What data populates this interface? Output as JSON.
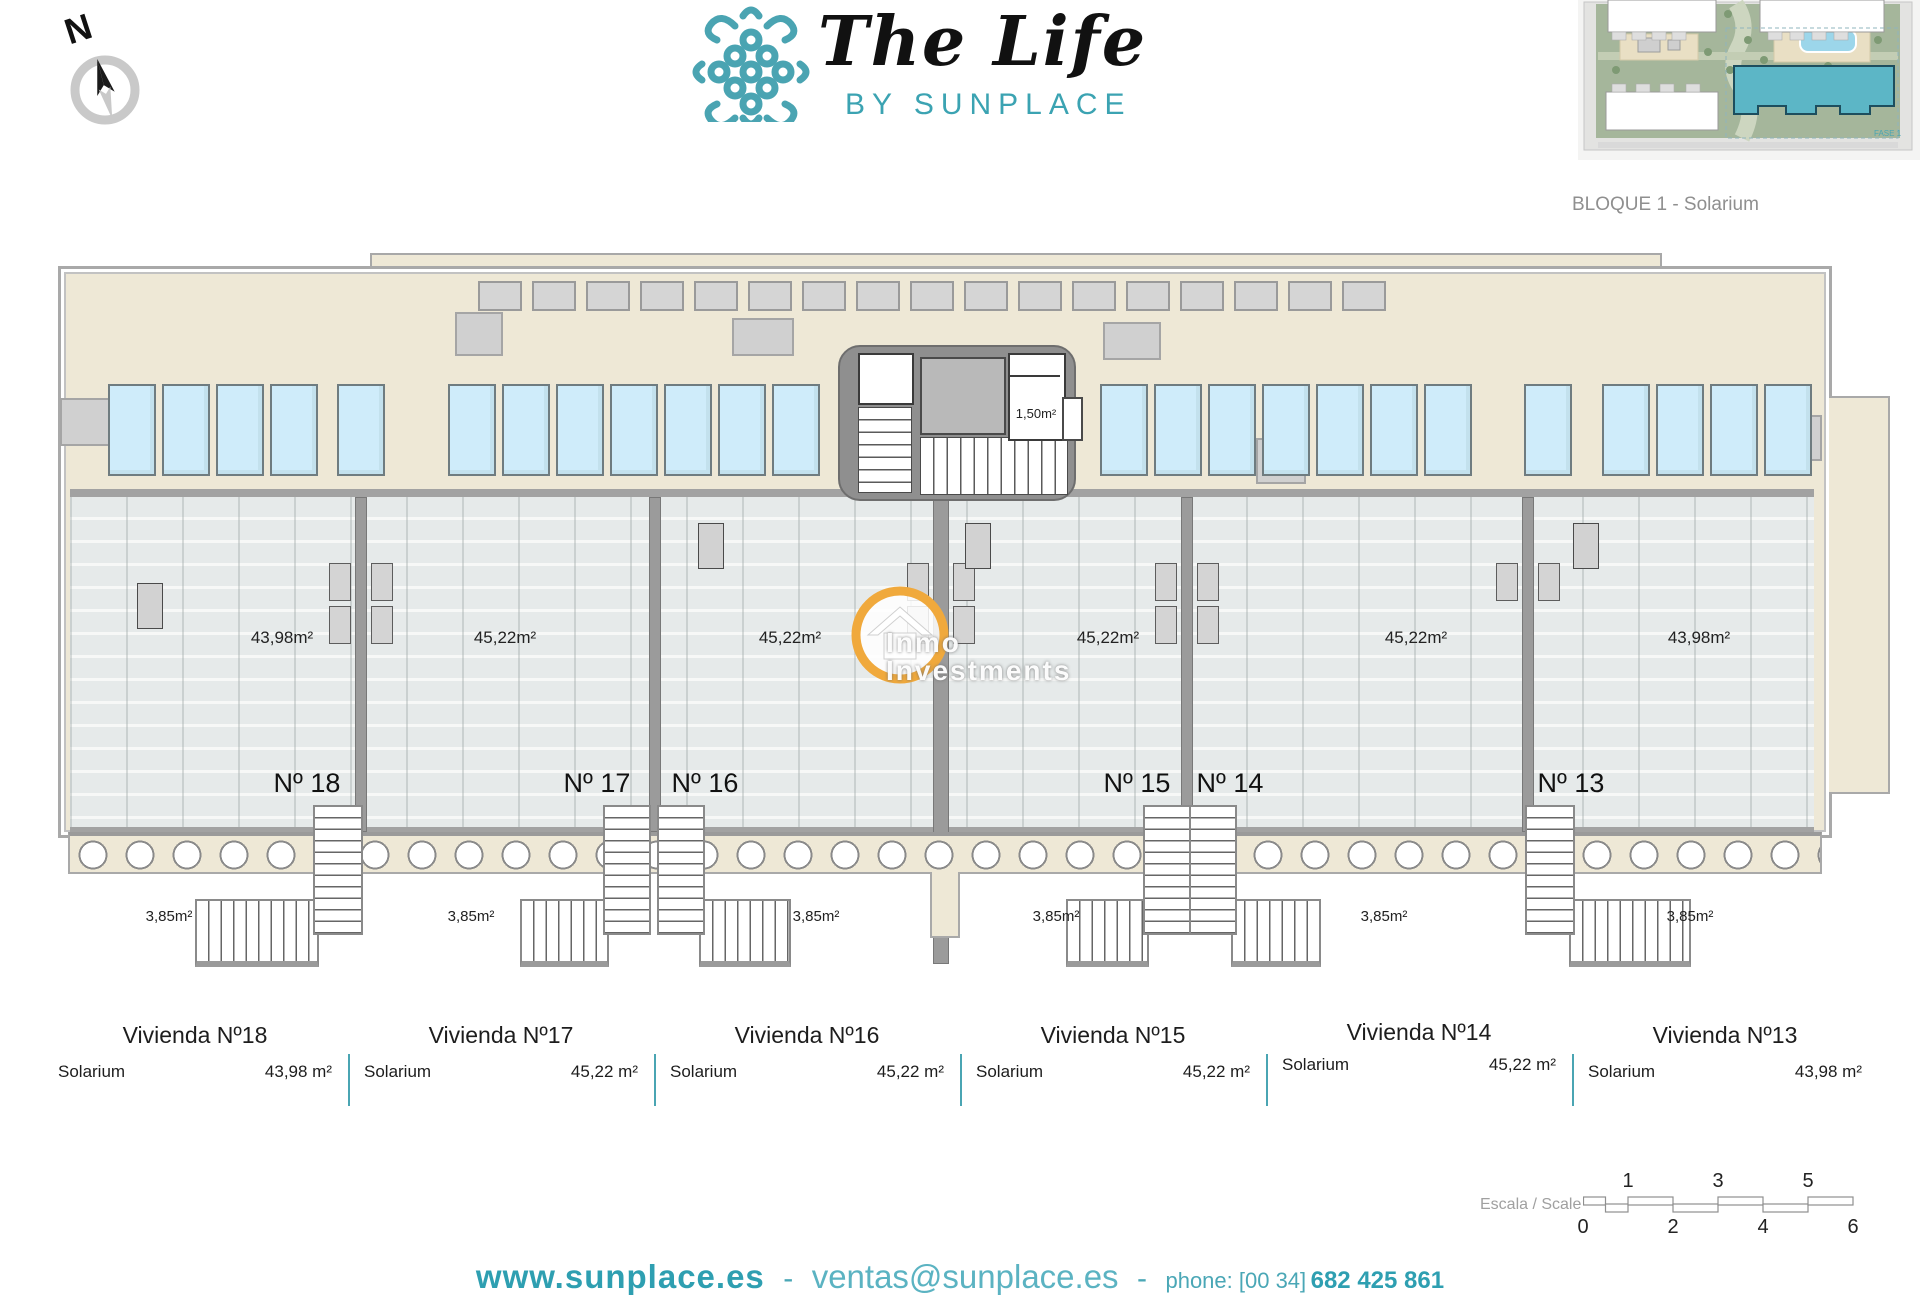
{
  "compass": {
    "letter": "N"
  },
  "logo": {
    "title": "The Life",
    "subtitle": "BY SUNPLACE"
  },
  "thumbnail": {
    "caption": "BLOQUE 1 - Solarium",
    "fase_label": "FASE 1"
  },
  "watermark": {
    "line1": "Inmo",
    "line2": "Investments"
  },
  "plan": {
    "core_wc_area": "1,50m²",
    "stair_area": "3,85m²",
    "units": [
      {
        "number": "Nº 18",
        "area": "43,98m²"
      },
      {
        "number": "Nº 17",
        "area": "45,22m²"
      },
      {
        "number": "Nº 16",
        "area": "45,22m²"
      },
      {
        "number": "Nº 15",
        "area": "45,22m²"
      },
      {
        "number": "Nº 14",
        "area": "45,22m²"
      },
      {
        "number": "Nº 13",
        "area": "43,98m²"
      }
    ]
  },
  "table": {
    "columns": [
      {
        "title": "Vivienda Nº18",
        "room": "Solarium",
        "value": "43,98 m²"
      },
      {
        "title": "Vivienda Nº17",
        "room": "Solarium",
        "value": "45,22 m²"
      },
      {
        "title": "Vivienda Nº16",
        "room": "Solarium",
        "value": "45,22 m²"
      },
      {
        "title": "Vivienda Nº15",
        "room": "Solarium",
        "value": "45,22 m²"
      },
      {
        "title": "Vivienda Nº14",
        "room": "Solarium",
        "value": "45,22 m²"
      },
      {
        "title": "Vivienda Nº13",
        "room": "Solarium",
        "value": "43,98 m²"
      }
    ]
  },
  "scale_bar": {
    "label": "Escala / Scale",
    "top_numbers": [
      "1",
      "3",
      "5"
    ],
    "bottom_numbers": [
      "0",
      "2",
      "4",
      "6"
    ]
  },
  "footer": {
    "website": "www.sunplace.es",
    "separator": "-",
    "email": "ventas@sunplace.es",
    "phone_prefix": "phone: [00 34]",
    "phone_number": "682 425 861"
  },
  "colors": {
    "brand_teal": "#3ba3b2",
    "table_divider_teal": "#4aa5b3",
    "beige": "#eee8d6",
    "pool_blue": "#cfecfa",
    "tile_gray": "#e6eaea",
    "wall_gray": "#8f8f8f",
    "watermark_orange": "#f0a93c"
  },
  "decor": {
    "pools": {
      "x_positions": [
        108,
        162,
        216,
        270,
        337,
        448,
        502,
        556,
        610,
        664,
        718,
        772,
        1100,
        1154,
        1208,
        1262,
        1316,
        1370,
        1424,
        1524,
        1602,
        1656,
        1710,
        1764
      ]
    },
    "sunbeds": {
      "start_x": 478,
      "pitch": 54,
      "count": 17
    }
  }
}
